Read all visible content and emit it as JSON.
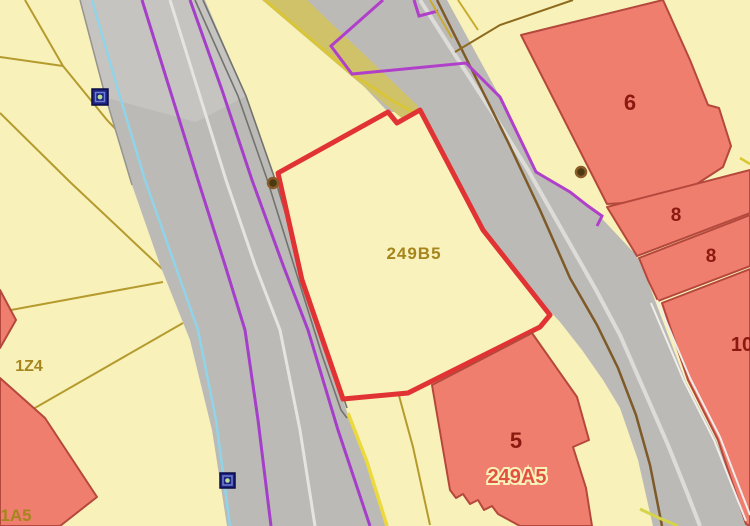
{
  "map": {
    "type": "cadastral-parcel-map",
    "selected_parcel": "249B5"
  },
  "labels": [
    {
      "name": "parcel-249B5-label",
      "text": "249B5"
    },
    {
      "name": "building-6-label",
      "text": "6"
    },
    {
      "name": "building-8a-label",
      "text": "8"
    },
    {
      "name": "building-8b-label",
      "text": "8"
    },
    {
      "name": "building-10-label",
      "text": "10"
    },
    {
      "name": "building-5-label",
      "text": "5"
    },
    {
      "name": "parcel-249A5-label",
      "text": "249A5"
    },
    {
      "name": "parcel-1Z4-label",
      "text": "1Z4"
    },
    {
      "name": "parcel-1A5-label",
      "text": "1A5"
    }
  ],
  "markers": {
    "blue_nodes": [
      {
        "name": "utility-node-icon-1",
        "glyph": "blue-square-green-dot"
      },
      {
        "name": "utility-node-icon-2",
        "glyph": "blue-square-green-dot"
      }
    ],
    "survey_points": [
      {
        "name": "survey-point-icon-1",
        "glyph": "brown-circle"
      },
      {
        "name": "survey-point-icon-2",
        "glyph": "brown-circle"
      }
    ]
  },
  "colors": {
    "background_cream": "#f8f1ba",
    "road_gray": "#bcbab7",
    "road_light_gray": "#c9c7c3",
    "building_fill": "#ef7e6e",
    "building_border": "#b5483c",
    "highlight_parcel_red": "#e23334",
    "boundary_purple": "#a53ec9",
    "utility_cyan": "#8fd4e8",
    "parcel_line_olive": "#b59b2e",
    "bright_yellow_line": "#ecd93e",
    "utility_brown": "#7d5a28",
    "khaki_strip": "#d0c269",
    "white_line": "#e6e4e0",
    "label_olive": "#a5851c",
    "label_dark_red": "#8a1a10",
    "label_red": "#e0523f",
    "marker_blue": "#1f2280",
    "marker_green": "#b8e09a"
  }
}
